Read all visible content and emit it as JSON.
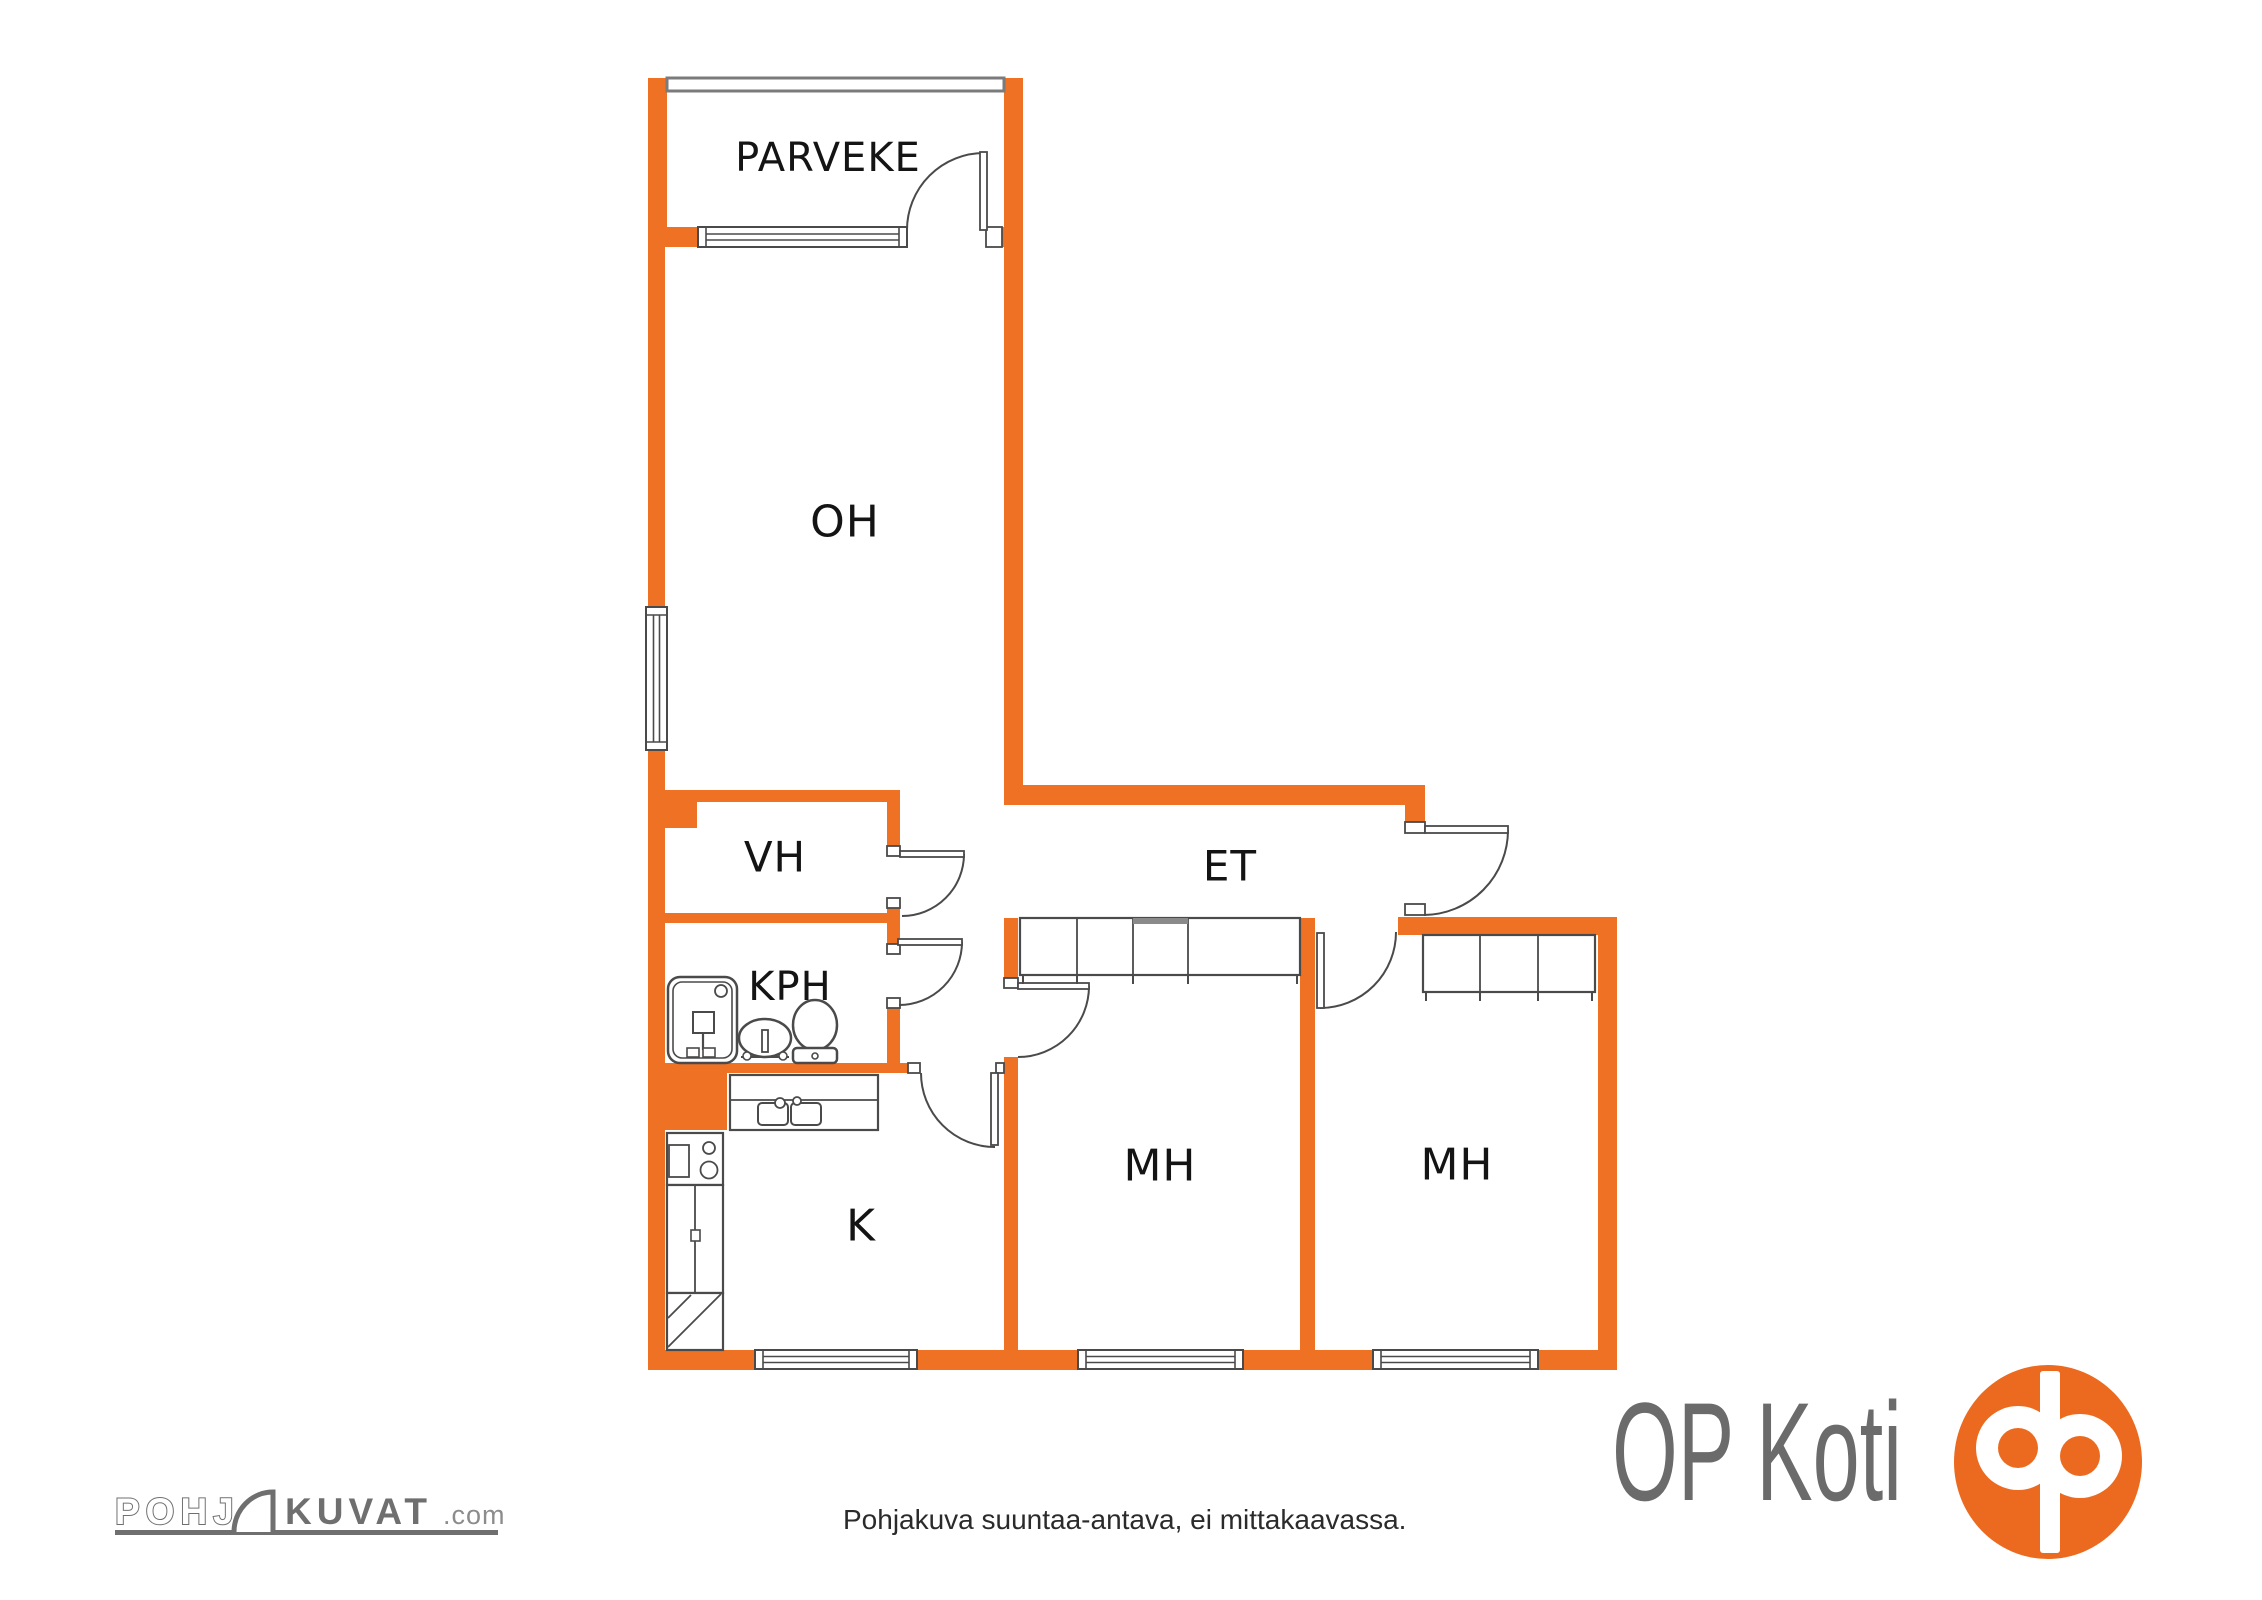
{
  "colors": {
    "wall": "#EE7124",
    "line": "#4A4A4A",
    "label": "#141414",
    "railing": "#7B7B7B",
    "slide": "#8A8A8A",
    "white": "#FFFFFF",
    "logo_gray": "#6F6F6F",
    "logo_gray_light": "#8C8C8C",
    "op_text": "#6B6B6B",
    "op_orange": "#EC6A1F",
    "disclaimer_color": "#2B2B2B"
  },
  "rooms": [
    {
      "name": "parveke",
      "label": "PARVEKE",
      "x": 828,
      "y": 158,
      "size": 40
    },
    {
      "name": "oh",
      "label": "OH",
      "x": 845,
      "y": 522,
      "size": 44
    },
    {
      "name": "vh",
      "label": "VH",
      "x": 775,
      "y": 857,
      "size": 42
    },
    {
      "name": "kph",
      "label": "KPH",
      "x": 790,
      "y": 987,
      "size": 40
    },
    {
      "name": "et",
      "label": "ET",
      "x": 1230,
      "y": 866,
      "size": 42
    },
    {
      "name": "k",
      "label": "K",
      "x": 861,
      "y": 1226,
      "size": 44
    },
    {
      "name": "mh1",
      "label": "MH",
      "x": 1160,
      "y": 1166,
      "size": 44
    },
    {
      "name": "mh2",
      "label": "MH",
      "x": 1457,
      "y": 1165,
      "size": 44
    }
  ],
  "plan": {
    "walls": [
      {
        "name": "balcony-wall-left",
        "rect": [
          648,
          78,
          19,
          149
        ]
      },
      {
        "name": "balcony-wall-right",
        "rect": [
          1004,
          78,
          19,
          149
        ]
      },
      {
        "name": "oh-top-wall-left",
        "rect": [
          648,
          227,
          52,
          20
        ]
      },
      {
        "name": "oh-top-wall-right",
        "rect": [
          986,
          227,
          37,
          20
        ]
      },
      {
        "name": "west-wall-upper",
        "rect": [
          648,
          247,
          17,
          360
        ]
      },
      {
        "name": "west-wall-mid",
        "rect": [
          648,
          750,
          17,
          313
        ]
      },
      {
        "name": "kitchen-corner-block",
        "rect": [
          648,
          1063,
          79,
          67
        ]
      },
      {
        "name": "west-wall-lower",
        "rect": [
          648,
          1130,
          17,
          240
        ]
      },
      {
        "name": "oh-east-wall",
        "rect": [
          1004,
          247,
          19,
          558
        ]
      },
      {
        "name": "et-north-wall",
        "rect": [
          1004,
          785,
          421,
          20
        ]
      },
      {
        "name": "entry-stub",
        "rect": [
          1405,
          805,
          20,
          17
        ]
      },
      {
        "name": "vh-north-wall",
        "rect": [
          648,
          790,
          252,
          12
        ]
      },
      {
        "name": "vh-corner-block",
        "rect": [
          665,
          802,
          32,
          26
        ]
      },
      {
        "name": "vh-east-wall-upper",
        "rect": [
          887,
          802,
          13,
          44
        ]
      },
      {
        "name": "vh-east-wall-lower",
        "rect": [
          887,
          908,
          13,
          36
        ]
      },
      {
        "name": "vh-south-wall",
        "rect": [
          648,
          913,
          239,
          10
        ]
      },
      {
        "name": "kph-east-wall-lower",
        "rect": [
          887,
          1008,
          13,
          65
        ]
      },
      {
        "name": "kph-south-wall",
        "rect": [
          648,
          1063,
          272,
          10
        ]
      },
      {
        "name": "mh1-west-stub",
        "rect": [
          1004,
          918,
          14,
          70
        ]
      },
      {
        "name": "mh1-west-wall",
        "rect": [
          1004,
          1057,
          14,
          313
        ]
      },
      {
        "name": "mh-divider-wall",
        "rect": [
          1300,
          918,
          15,
          432
        ]
      },
      {
        "name": "et-south-wall-east",
        "rect": [
          1398,
          917,
          219,
          18
        ]
      },
      {
        "name": "mh2-east-wall",
        "rect": [
          1598,
          935,
          19,
          435
        ]
      },
      {
        "name": "south-wall-1",
        "rect": [
          648,
          1350,
          107,
          20
        ]
      },
      {
        "name": "south-wall-2",
        "rect": [
          917,
          1350,
          161,
          20
        ]
      },
      {
        "name": "south-wall-3",
        "rect": [
          1243,
          1350,
          130,
          20
        ]
      },
      {
        "name": "south-wall-4",
        "rect": [
          1538,
          1350,
          79,
          20
        ]
      }
    ],
    "railing": {
      "name": "balcony-railing",
      "rect": [
        667,
        78,
        337,
        13
      ]
    },
    "windows": [
      {
        "name": "oh-west-window",
        "orient": "v",
        "rect": [
          646,
          607,
          21,
          143
        ]
      },
      {
        "name": "balcony-window",
        "orient": "h",
        "rect": [
          698,
          227,
          209,
          20
        ]
      },
      {
        "name": "kitchen-window",
        "orient": "h",
        "rect": [
          755,
          1350,
          162,
          19
        ]
      },
      {
        "name": "mh1-window",
        "orient": "h",
        "rect": [
          1078,
          1350,
          165,
          19
        ]
      },
      {
        "name": "mh2-window",
        "orient": "h",
        "rect": [
          1373,
          1350,
          165,
          19
        ]
      }
    ],
    "jamb_caps": [
      [
        887,
        846,
        13,
        10
      ],
      [
        887,
        898,
        13,
        10
      ],
      [
        887,
        944,
        13,
        10
      ],
      [
        887,
        998,
        13,
        10
      ],
      [
        908,
        1063,
        12,
        10
      ],
      [
        996,
        1063,
        8,
        10
      ],
      [
        1004,
        978,
        14,
        10
      ],
      [
        986,
        227,
        16,
        20
      ],
      [
        1405,
        822,
        20,
        11
      ],
      [
        1405,
        904,
        20,
        11
      ]
    ],
    "doors": [
      {
        "name": "balcony-door",
        "leaf": [
          980,
          152,
          7,
          78
        ],
        "arc": "M 907 230 A 77 77 0 0 1 984 153"
      },
      {
        "name": "entry-door",
        "leaf": [
          1425,
          826,
          83,
          7
        ],
        "arc": "M 1508 830 A 85 85 0 0 1 1424 915"
      },
      {
        "name": "vh-door",
        "leaf": [
          900,
          851,
          64,
          6
        ],
        "arc": "M 964 854 A 62 62 0 0 1 902 916"
      },
      {
        "name": "kph-door",
        "leaf": [
          898,
          939,
          64,
          6
        ],
        "arc": "M 962 942 A 63 63 0 0 1 899 1005"
      },
      {
        "name": "kitchen-door",
        "leaf": [
          991,
          1073,
          7,
          72
        ],
        "arc": "M 921 1073 A 74 74 0 0 0 995 1147"
      },
      {
        "name": "mh1-door",
        "leaf": [
          1018,
          983,
          71,
          6
        ],
        "arc": "M 1089 986 A 71 71 0 0 1 1018 1057"
      },
      {
        "name": "mh2-door",
        "leaf": [
          1317,
          933,
          7,
          75
        ],
        "arc": "M 1320 1008 A 76 76 0 0 0 1396 932"
      }
    ],
    "closets": [
      {
        "name": "mh1-closets",
        "rect": [
          1020,
          918,
          280,
          57
        ],
        "dividers": [
          1077,
          1133,
          1188
        ],
        "slide_top": [
          1133,
          1188
        ],
        "ticks": [
          1023,
          1077,
          1133,
          1188,
          1297
        ]
      },
      {
        "name": "mh2-closets",
        "rect": [
          1423,
          935,
          172,
          57
        ],
        "dividers": [
          1480,
          1538
        ],
        "ticks": [
          1426,
          1480,
          1538,
          1592
        ]
      }
    ],
    "kitchen": {
      "counter": [
        730,
        1075,
        148,
        55
      ],
      "counter_line_y": 1100,
      "basins": [
        [
          758,
          1103,
          30,
          22
        ],
        [
          791,
          1103,
          30,
          22
        ]
      ],
      "faucets": [
        [
          780,
          1103,
          5
        ],
        [
          797,
          1101,
          4
        ]
      ],
      "stove": [
        667,
        1133,
        56,
        52
      ],
      "oven": [
        669,
        1145,
        20,
        32
      ],
      "burners": [
        [
          709,
          1148,
          6
        ],
        [
          709,
          1170,
          8.5
        ]
      ],
      "fridge": [
        667,
        1185,
        56,
        108
      ],
      "fridge_divider_x": 695,
      "fridge_handle": [
        691,
        1230,
        9,
        11
      ],
      "reserve": [
        667,
        1293,
        56,
        57
      ],
      "diagonals": [
        [
          668,
          1347,
          721,
          1294
        ],
        [
          668,
          1318,
          691,
          1295
        ]
      ]
    },
    "bathroom": {
      "tub_outer": [
        668,
        977,
        69,
        86
      ],
      "tub_inner": [
        673,
        982,
        59,
        76
      ],
      "drain": [
        721,
        991,
        6
      ],
      "shower_box": [
        693,
        1012,
        21,
        21
      ],
      "shower_stem": [
        703,
        1033,
        703,
        1050
      ],
      "handles": [
        [
          687,
          1048,
          12,
          9
        ],
        [
          703,
          1048,
          12,
          9
        ]
      ],
      "sink_bowl": [
        765,
        1038,
        26,
        19
      ],
      "sink_base": [
        741,
        1057,
        48
      ],
      "sink_tap": [
        762,
        1030,
        6,
        22
      ],
      "sink_knobs": [
        [
          747,
          1056,
          4
        ],
        [
          783,
          1056,
          4
        ]
      ],
      "wc_bowl": [
        815,
        1025,
        22,
        25
      ],
      "wc_tank": [
        793,
        1048,
        44,
        15
      ],
      "wc_button": [
        815,
        1056,
        3
      ]
    }
  },
  "footer": {
    "brand_prefix": "POHJ",
    "brand_suffix": "KUVAT",
    "brand_tld": ".com",
    "disclaimer": "Pohjakuva suuntaa-antava, ei mittakaavassa.",
    "op_koti": "OP Koti"
  }
}
